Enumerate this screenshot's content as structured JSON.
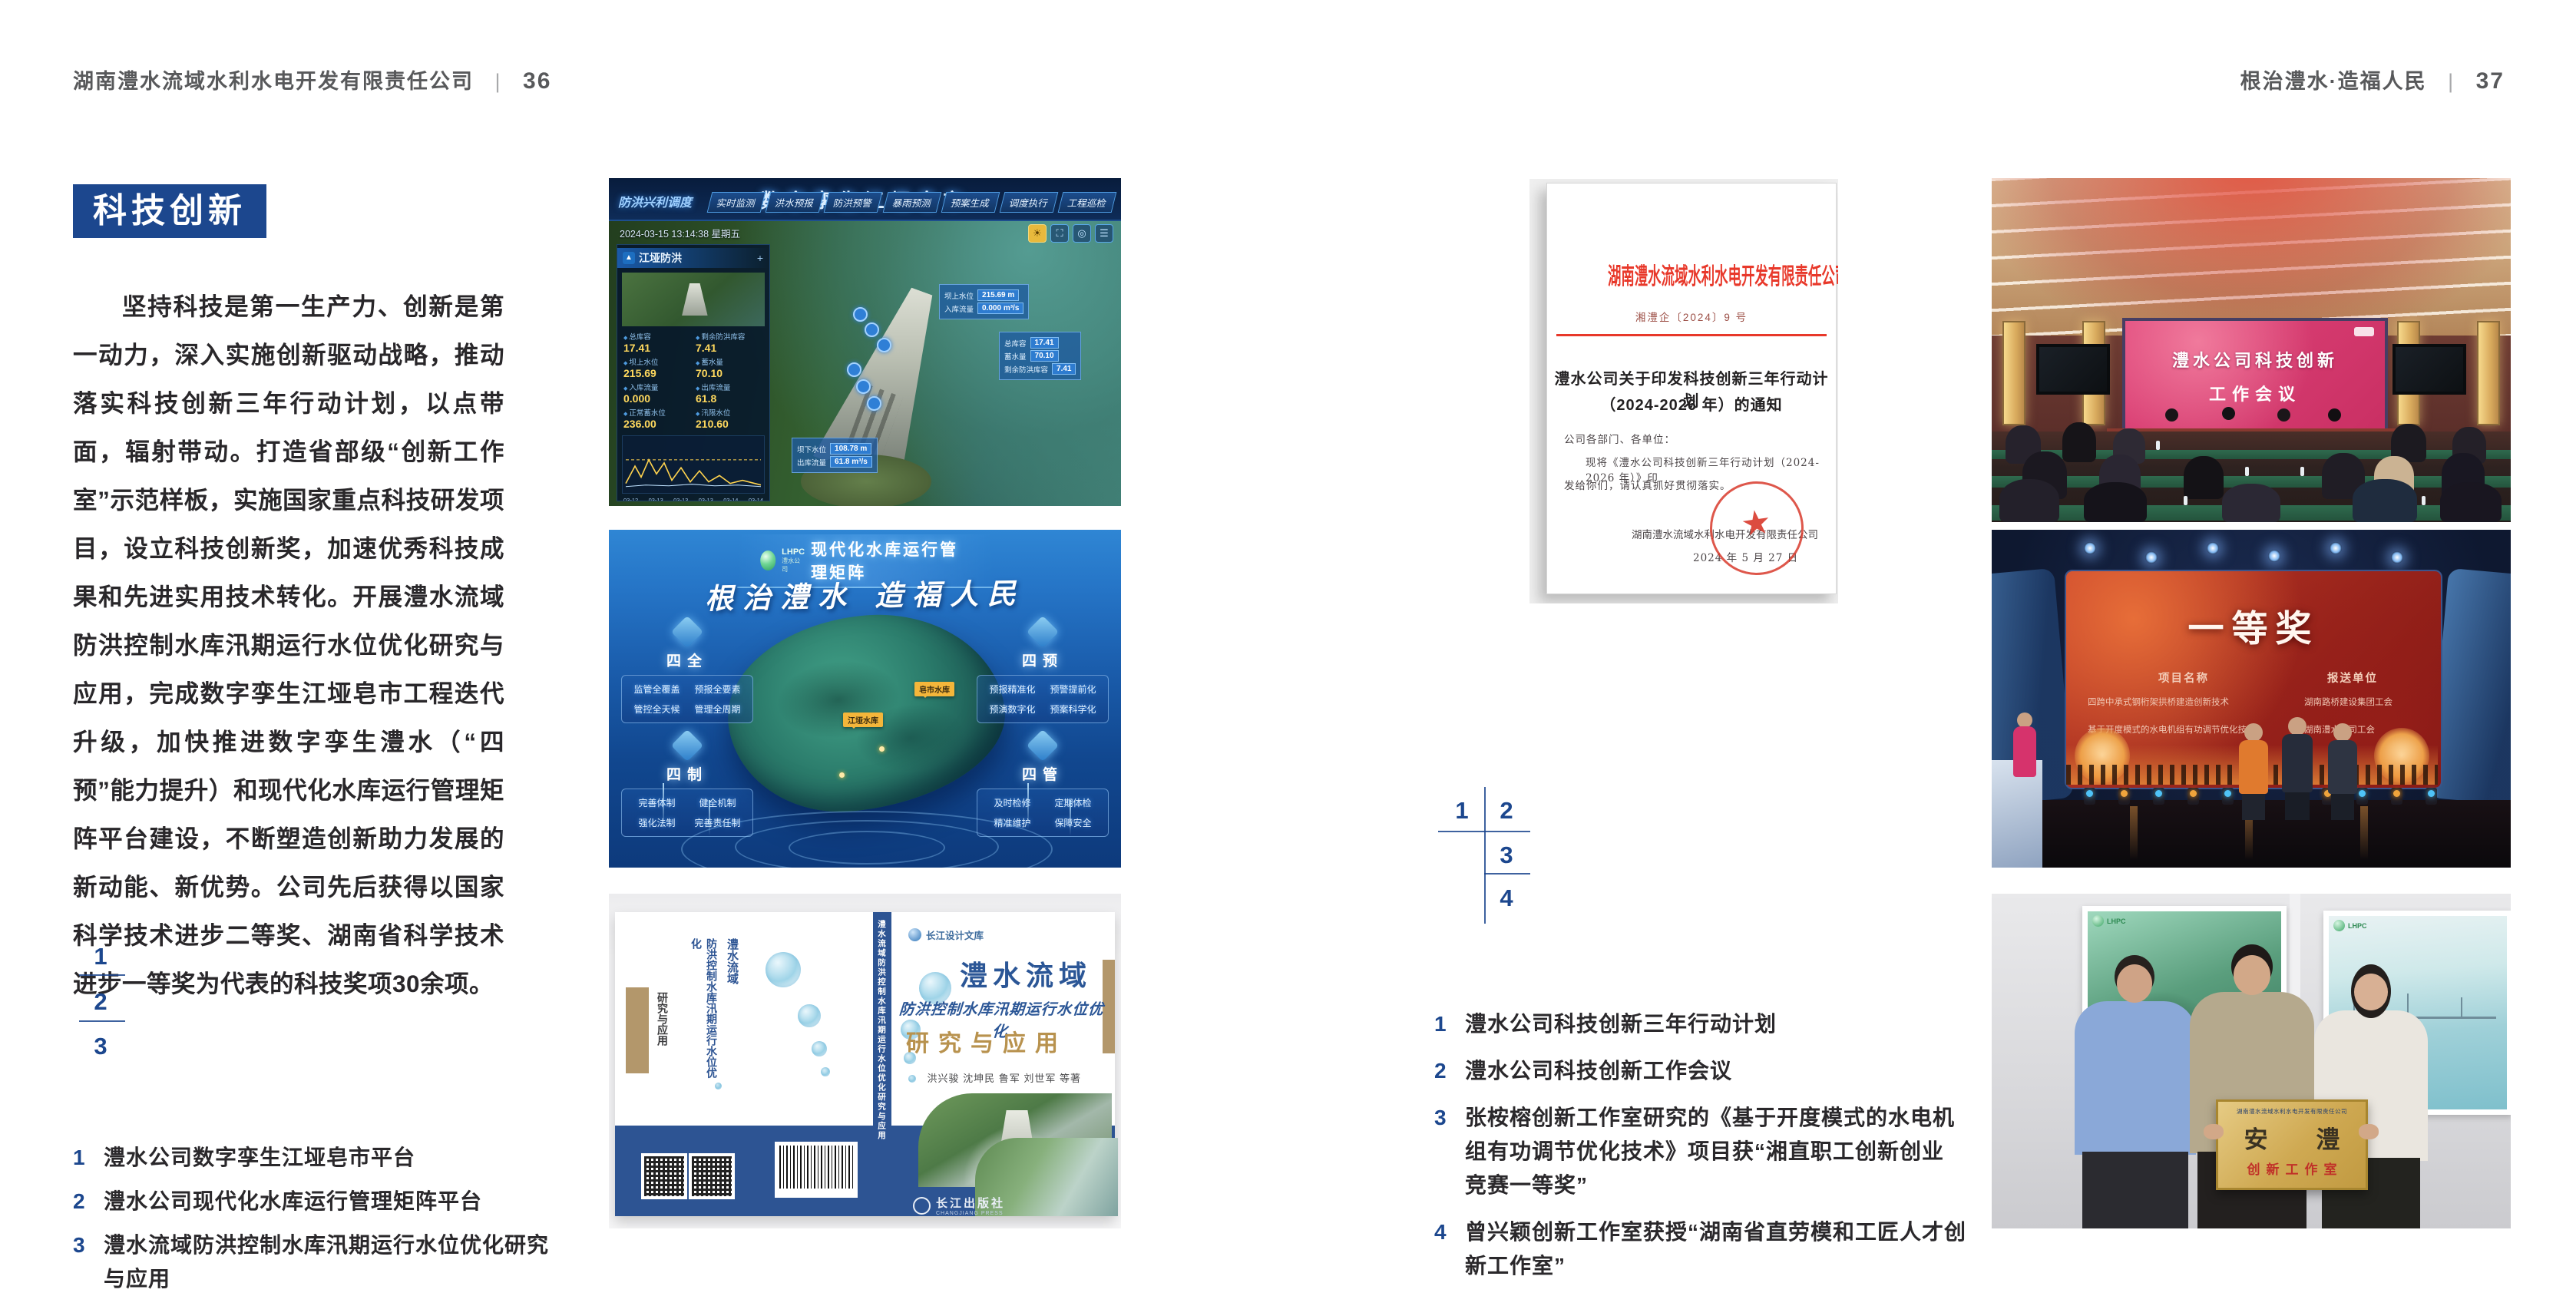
{
  "colors": {
    "accent_blue": "#1c478e",
    "doc_red": "#e8382a",
    "body_text": "#29272a",
    "header_gray": "#58595b"
  },
  "left_page": {
    "header": {
      "company": "湖南澧水流域水利水电开发有限责任公司",
      "divider": "|",
      "page_number": "36"
    },
    "badge": "科技创新",
    "paragraph": "坚持科技是第一生产力、创新是第一动力，深入实施创新驱动战略，推动落实科技创新三年行动计划，以点带面，辐射带动。打造省部级“创新工作室”示范样板，实施国家重点科技研发项目，设立科技创新奖，加速优秀科技成果和先进实用技术转化。开展澧水流域防洪控制水库汛期运行水位优化研究与应用，完成数字孪生江垭皂市工程迭代升级，加快推进数字孪生澧水（“四预”能力提升）和现代化水库运行管理矩阵平台建设，不断塑造创新助力发展的新动能、新优势。公司先后获得以国家科学技术进步二等奖、湖南省科学技术进步一等奖为代表的科技奖项30余项。",
    "index": {
      "n1": "1",
      "n2": "2",
      "n3": "3"
    },
    "captions": [
      {
        "num": "1",
        "text": "澧水公司数字孪生江垭皂市平台"
      },
      {
        "num": "2",
        "text": "澧水公司现代化水库运行管理矩阵平台"
      },
      {
        "num": "3",
        "text": "澧水流域防洪控制水库汛期运行水位优化研究与应用"
      }
    ]
  },
  "right_page": {
    "header": {
      "slogan": "根治澧水·造福人民",
      "divider": "|",
      "page_number": "37"
    },
    "index": {
      "n1": "1",
      "n2": "2",
      "n3": "3",
      "n4": "4"
    },
    "captions": [
      {
        "num": "1",
        "text": "澧水公司科技创新三年行动计划"
      },
      {
        "num": "2",
        "text": "澧水公司科技创新工作会议"
      },
      {
        "num": "3",
        "text": "张桉榕创新工作室研究的《基于开度模式的水电机组有功调节优化技术》项目获“湘直职工创新创业竞赛一等奖”"
      },
      {
        "num": "4",
        "text": "曾兴颖创新工作室获授“湖南省直劳模和工匠人才创新工作室”"
      }
    ]
  },
  "figures": {
    "digital_twin": {
      "title": "数字孪生江垭皂市",
      "menu_label": "防洪兴利调度",
      "tabs_left": [
        "实时监测",
        "洪水预报",
        "防洪预警"
      ],
      "tabs_right": [
        "暴雨预测",
        "预案生成",
        "调度执行",
        "工程巡检"
      ],
      "timestamp": "2024-03-15 13:14:38 星期五",
      "panel_flood_title": "江垭防洪",
      "flood_stats": [
        {
          "label": "总库容",
          "value": "17.41",
          "unit": "亿m³"
        },
        {
          "label": "剩余防洪库容",
          "value": "7.41",
          "unit": "亿m³"
        },
        {
          "label": "坝上水位",
          "value": "215.69",
          "unit": "m"
        },
        {
          "label": "蓄水量",
          "value": "70.10",
          "unit": "亿m³"
        },
        {
          "label": "入库流量",
          "value": "0.000",
          "unit": "m³/s"
        },
        {
          "label": "出库流量",
          "value": "61.8",
          "unit": "m³/s"
        },
        {
          "label": "正常蓄水位",
          "value": "236.00",
          "unit": "m"
        },
        {
          "label": "汛限水位",
          "value": "210.60",
          "ununit": "",
          "unit": "m"
        }
      ],
      "chart_x": [
        "03-12",
        "03-13",
        "03-13",
        "03-13",
        "03-14",
        "03-14"
      ],
      "panel_power_title": "江垭发电",
      "power_stats": [
        {
          "label": "年发电计划",
          "value": "6.3000",
          "unit": "亿度"
        },
        {
          "label": "年累计发电量",
          "value": "12907",
          "unit": "万度"
        },
        {
          "label": "月累计发电量",
          "value": "3359.21",
          "unit": "万度"
        },
        {
          "label": "当前出力",
          "value": "0.00",
          "unit": "MW"
        },
        {
          "label": "发电流量",
          "value": "0.00",
          "unit": "m³/s"
        },
        {
          "label": "弃水流量",
          "value": "0.00",
          "unit": "m³/s"
        }
      ],
      "tag_upper_label1": "坝上水位",
      "tag_upper_value1": "215.69 m",
      "tag_upper_label2": "入库流量",
      "tag_upper_value2": "0.000 m³/s",
      "tag_lower_label1": "坝下水位",
      "tag_lower_value1": "108.78 m",
      "tag_lower_label2": "出库流量",
      "tag_lower_value2": "61.8 m³/s"
    },
    "matrix": {
      "logo_text": "LHPC",
      "logo_sub": "澧水公司",
      "title": "现代化水库运行管理矩阵",
      "slogan": "根治澧水 造福人民",
      "quadrants": [
        {
          "title": "四全",
          "items": [
            "监管全覆盖",
            "预报全要素",
            "管控全天候",
            "管理全周期"
          ]
        },
        {
          "title": "四预",
          "items": [
            "预报精准化",
            "预警提前化",
            "预演数字化",
            "预案科学化"
          ]
        },
        {
          "title": "四制",
          "items": [
            "完善体制",
            "健全机制",
            "强化法制",
            "完善责任制"
          ]
        },
        {
          "title": "四管",
          "items": [
            "及时检修",
            "定期体检",
            "精准维护",
            "保障安全"
          ]
        }
      ],
      "map_label_1": "皂市水库",
      "map_label_2": "江垭水库"
    },
    "book": {
      "series": "长江设计文库",
      "title1": "澧水流域",
      "title2": "防洪控制水库汛期运行水位优化",
      "title3": "研究与应用",
      "authors": "洪兴骏  沈坤民  鲁军  刘世军  等著",
      "publisher": "长江出版社",
      "publisher_en": "CHANGJIANG PRESS",
      "spine": "澧水流域防洪控制水库汛期运行水位优化研究与应用"
    },
    "document": {
      "header": "湖南澧水流域水利水电开发有限责任公司文件",
      "number": "湘澧企〔2024〕9 号",
      "title1": "澧水公司关于印发科技创新三年行动计划",
      "title2": "（2024-2026 年）的通知",
      "salutation": "公司各部门、各单位：",
      "body1": "现将《澧水公司科技创新三年行动计划（2024-2026 年）》印",
      "body2": "发给你们，请认真抓好贯彻落实。",
      "signer": "湖南澧水流域水利水电开发有限责任公司",
      "date": "2024 年 5 月 27 日",
      "seal_star": "★"
    },
    "meeting": {
      "screen_line1": "澧水公司科技创新",
      "screen_line2": "工作会议"
    },
    "award": {
      "title": "一等奖",
      "col1_header": "项目名称",
      "col2_header": "报送单位",
      "row1_col1": "四跨中承式钢桁架拱桥建造创新技术",
      "row1_col2": "湖南路桥建设集团工会",
      "row2_col1": "基于开度模式的水电机组有功调节优化技术",
      "row2_col2": "湖南澧水公司工会"
    },
    "group": {
      "plaque_org": "湖南澧水流域水利水电开发有限责任公司",
      "plaque_main": "安 澧",
      "plaque_sub": "创新工作室",
      "poster_logo": "LHPC"
    }
  }
}
